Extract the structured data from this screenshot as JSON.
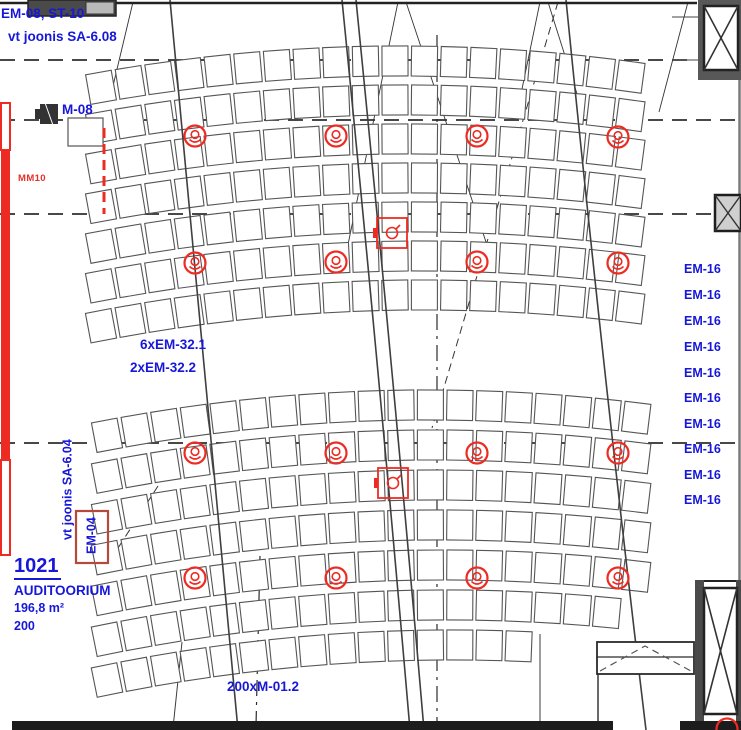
{
  "drawing": {
    "labels": {
      "top_ref_line1": "EM-08, ST-10",
      "top_ref_line2": "vt joonis SA-6.08",
      "motor_label": "M-08",
      "mm10_label": "MM10",
      "em32_line1": "6xEM-32.1",
      "em32_line2": "2xEM-32.2",
      "bottom_label": "200xM-01.2",
      "side_ref_vertical": "vt joonis SA-6.04",
      "em04_label": "EM-04"
    },
    "room": {
      "number": "1021",
      "name": "AUDITOORIUM",
      "area": "196,8 m²",
      "capacity": "200"
    },
    "em16_labels": {
      "text": "EM-16",
      "x": 684,
      "ys": [
        263,
        289,
        315,
        341,
        367,
        392,
        418,
        443,
        469,
        494
      ]
    },
    "devices": {
      "circle_symbols": [
        [
          195,
          136
        ],
        [
          336,
          136
        ],
        [
          477,
          136
        ],
        [
          618,
          137
        ],
        [
          195,
          263
        ],
        [
          336,
          262
        ],
        [
          477,
          262
        ],
        [
          618,
          263
        ],
        [
          195,
          453
        ],
        [
          336,
          453
        ],
        [
          477,
          453
        ],
        [
          618,
          453
        ],
        [
          195,
          578
        ],
        [
          336,
          578
        ],
        [
          477,
          578
        ],
        [
          618,
          578
        ]
      ],
      "square_symbols": [
        [
          392,
          233
        ],
        [
          393,
          483
        ]
      ],
      "corner_partial_circle": [
        727,
        729
      ]
    },
    "colors": {
      "label_blue": "#1717d9",
      "device_red": "#ee2b22",
      "mm10_red": "#e43027",
      "em04_box": "#b5493c",
      "wall_dark": "#4a4a4a",
      "seat_line": "#555555",
      "grid_line": "#2e2e2e"
    }
  }
}
